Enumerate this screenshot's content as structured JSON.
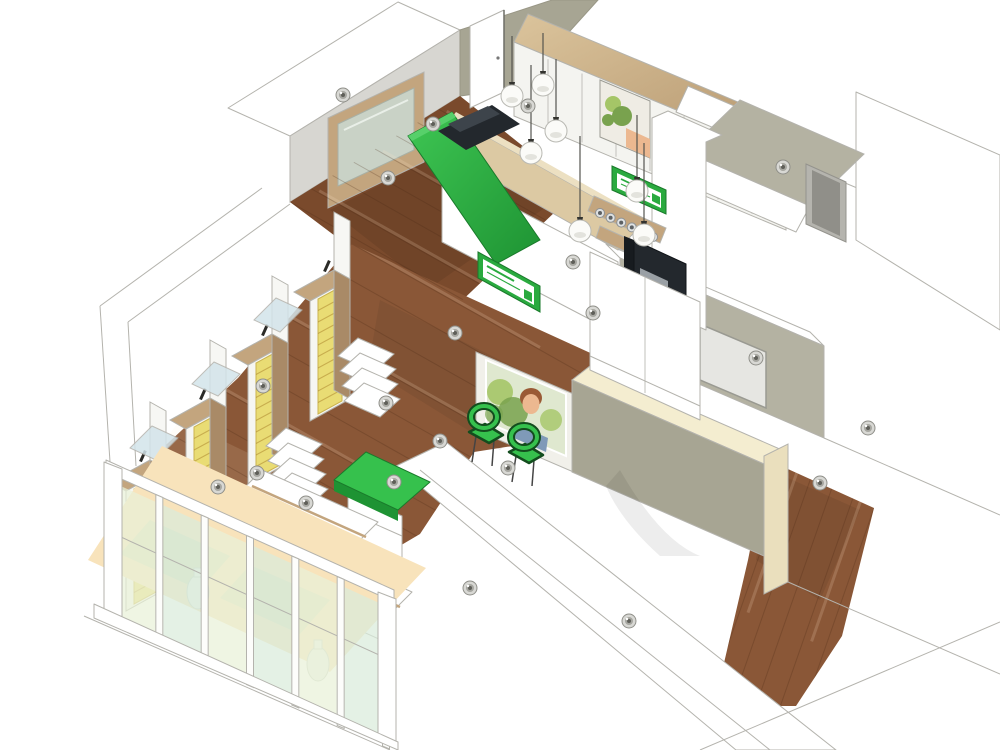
{
  "meta": {
    "title": "Pharmacy shop interior - 3D isometric cutaway rendering",
    "style": "architectural visualization, white cutaway walls, no readable text",
    "signs_note": "green brand logotype panels on reception counter and coffee bar (illegible at this scale)"
  },
  "palette": {
    "white": "#ffffff",
    "wall_stroke": "#b4b3ad",
    "wall_gray": "#d7d6d1",
    "wall_light": "#efeeea",
    "olive": "#a7a593",
    "olive_light": "#b4b2a2",
    "olive_dark": "#999786",
    "ivory": "#f4edd0",
    "ivory_dark": "#eadfbd",
    "wood_floor": "#8a5737",
    "wood_floor_dark": "#7a4a2c",
    "wood_light": "#dcc9a3",
    "wood_mid": "#c3a57e",
    "wood_side": "#a98a67",
    "green": "#2aaa3f",
    "green_dark": "#1e9333",
    "green_bright": "#36c14d",
    "green_outline": "#134d1e",
    "yellow": "#e9dc74",
    "glass": "#e9f1d8",
    "glass_mint": "#d9ecdb",
    "beige": "#f8e3bb",
    "device": "#23282d",
    "device_hi": "#3d444b",
    "steel": "#c9c9c4",
    "steel_dark": "#74746d",
    "board": "#e6e6e2",
    "peach": "#ecb890",
    "hair": "#9a5a35",
    "leaf": "#79a24e",
    "leaf_light": "#a5c567"
  },
  "scene": {
    "counts": {
      "ceiling_spotlights": 21,
      "pendant_lamps": 7,
      "shelving_gondolas": 4,
      "tiered_shelf_stacks": 3,
      "green_chairs": 2,
      "glass_panes": 6,
      "espresso_cups": 6,
      "window_vases": 2,
      "doors": 2
    },
    "spotlights": [
      [
        388,
        178
      ],
      [
        433,
        124
      ],
      [
        343,
        95
      ],
      [
        528,
        106
      ],
      [
        573,
        262
      ],
      [
        593,
        313
      ],
      [
        455,
        333
      ],
      [
        386,
        403
      ],
      [
        263,
        386
      ],
      [
        218,
        487
      ],
      [
        306,
        503
      ],
      [
        440,
        441
      ],
      [
        508,
        468
      ],
      [
        470,
        588
      ],
      [
        394,
        482
      ],
      [
        257,
        473
      ],
      [
        756,
        358
      ],
      [
        820,
        483
      ],
      [
        868,
        428
      ],
      [
        629,
        621
      ],
      [
        783,
        167
      ]
    ],
    "pendants": [
      {
        "x": 512,
        "y": 96,
        "stem": 60
      },
      {
        "x": 543,
        "y": 85,
        "stem": 52
      },
      {
        "x": 556,
        "y": 131,
        "stem": 72
      },
      {
        "x": 531,
        "y": 153,
        "stem": 88
      },
      {
        "x": 580,
        "y": 231,
        "stem": 95
      },
      {
        "x": 637,
        "y": 191,
        "stem": 76
      },
      {
        "x": 644,
        "y": 235,
        "stem": 92
      }
    ],
    "gondolas": [
      [
        334,
        270
      ],
      [
        272,
        334
      ],
      [
        210,
        398
      ],
      [
        150,
        460
      ]
    ],
    "glass_bridges": [
      [
        276,
        298
      ],
      [
        214,
        362
      ],
      [
        152,
        426
      ]
    ],
    "tiered_stacks": [
      [
        358,
        338
      ],
      [
        286,
        428
      ],
      [
        218,
        498
      ]
    ],
    "chairs": [
      [
        486,
        434
      ],
      [
        526,
        454
      ]
    ],
    "cups": {
      "x0": 600,
      "y0": 213,
      "dx": 10.6,
      "dy": 4.8,
      "count": 6
    },
    "cabinet_seams": {
      "x0": 514,
      "y0": 42,
      "x1": 786,
      "y1": 156,
      "count": 7,
      "drop": 72
    },
    "glass_facade": {
      "x0": 114,
      "y0": 474,
      "x1": 386,
      "y1": 597,
      "posts": 7,
      "pane_top": 9,
      "pane_bottom": 148
    },
    "vases": [
      [
        198,
        592
      ],
      [
        318,
        664
      ]
    ],
    "planks": [
      {
        "clip": "cpRetail",
        "sx": 126,
        "sy": 482,
        "ex": 352,
        "ey": 244,
        "count": 11,
        "dx": 300,
        "dy": 169
      },
      {
        "clip": "cpBack",
        "sx": 290,
        "sy": 202,
        "ex": 460,
        "ey": 96,
        "count": 9,
        "dx": 278,
        "dy": 157
      },
      {
        "clip": "cpCorr",
        "sx": 768,
        "sy": 460,
        "ex": 874,
        "ey": 508,
        "count": 6,
        "dx": -82,
        "dy": 235
      }
    ],
    "inventory": [
      {
        "id": "reception-counter",
        "label": "reception counter with curved green front panel and POS register"
      },
      {
        "id": "brand-sign-counter",
        "label": "green brand logotype sign on counter front"
      },
      {
        "id": "back-wall-cabinets",
        "label": "white back-wall cabinet row with wood trim band"
      },
      {
        "id": "plant-picture",
        "label": "framed botanical artwork on back wall"
      },
      {
        "id": "coffee-bar",
        "label": "coffee corner: espresso machine, cup shelves, green sign"
      },
      {
        "id": "pendant-lamps",
        "label": "white globe pendant lamps over counter"
      },
      {
        "id": "shelving-gondolas",
        "label": "double-sided gondola shelving with yellow drawer stacks"
      },
      {
        "id": "tiered-display-shelves",
        "label": "white tiered display shelf stacks"
      },
      {
        "id": "green-display-table",
        "label": "green-top display table"
      },
      {
        "id": "low-display-counters",
        "label": "low white display counters along storefront"
      },
      {
        "id": "poster-woman",
        "label": "wall poster of a woman wearing glasses among greenery"
      },
      {
        "id": "green-chairs",
        "label": "two green visitor chairs"
      },
      {
        "id": "glass-facade",
        "label": "glazed storefront with white mullions and display vases"
      },
      {
        "id": "whiteboard",
        "label": "board panel on corridor wall"
      },
      {
        "id": "wood-floor",
        "label": "dark wood plank flooring"
      },
      {
        "id": "walls",
        "label": "white sectioned walls with olive interior faces"
      }
    ]
  }
}
